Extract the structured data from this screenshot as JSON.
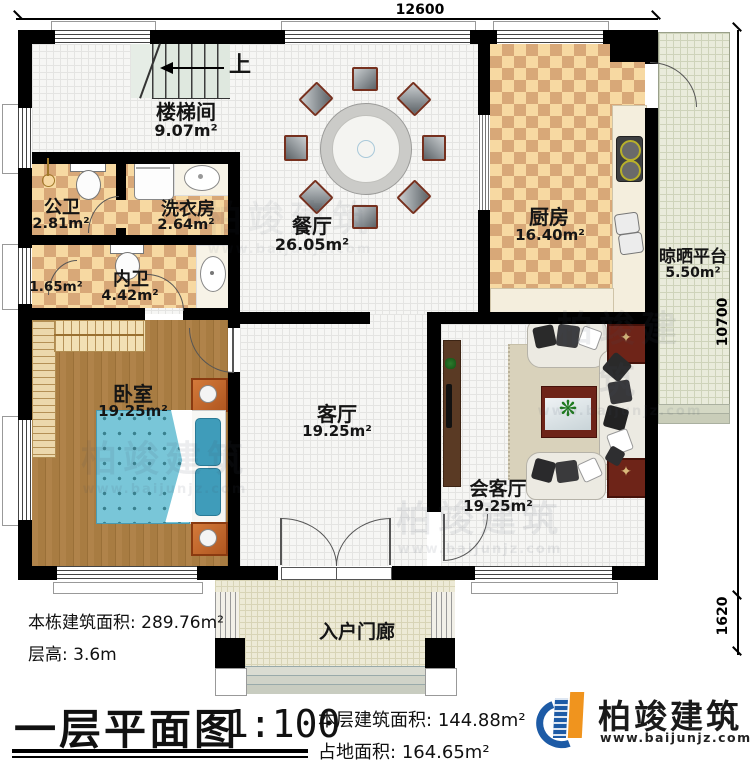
{
  "dimensions": {
    "top_width": "12600",
    "right_height": "10700",
    "porch_depth": "1620"
  },
  "stair": {
    "up_label": "上"
  },
  "rooms": {
    "stairwell": {
      "name": "楼梯间",
      "area": "9.07m²"
    },
    "public_bath": {
      "name": "公卫",
      "area": "2.81m²"
    },
    "laundry": {
      "name": "洗衣房",
      "area": "2.64m²"
    },
    "dining": {
      "name": "餐厅",
      "area": "26.05m²"
    },
    "kitchen": {
      "name": "厨房",
      "area": "16.40m²"
    },
    "drying_platform": {
      "name": "晾晒平台",
      "area": "5.50m²"
    },
    "closet": {
      "area": "1.65m²"
    },
    "master_bath": {
      "name": "内卫",
      "area": "4.42m²"
    },
    "bedroom": {
      "name": "卧室",
      "area": "19.25m²"
    },
    "living": {
      "name": "客厅",
      "area": "19.25m²"
    },
    "reception": {
      "name": "会客厅",
      "area": "19.25m²"
    },
    "porch": {
      "name": "入户门廊"
    }
  },
  "title_block": {
    "building_area_label": "本栋建筑面积:",
    "building_area_value": "289.76m²",
    "floor_height_label": "层高:",
    "floor_height_value": "3.6m",
    "drawing_title": "一层平面图",
    "scale": "1:100",
    "floor_area_label": "本层建筑面积:",
    "floor_area_value": "144.88m²",
    "footprint_label": "占地面积:",
    "footprint_value": "164.65m²"
  },
  "logo": {
    "name": "柏竣建筑",
    "website": "www.baijunjz.com"
  },
  "watermark": {
    "text": "柏竣建筑",
    "subtext": "www.baijunjz.com"
  },
  "glyphs": {
    "plant": "❋",
    "table_inlay": "✦"
  },
  "colors": {
    "wall": "#000000",
    "tile_light": "#f7d9a2",
    "tile_dark": "#d8a878",
    "wood": "#a87c42",
    "bed": "#79c6d8",
    "logo_blue": "#1d5ba6",
    "logo_orange": "#f0941e"
  }
}
